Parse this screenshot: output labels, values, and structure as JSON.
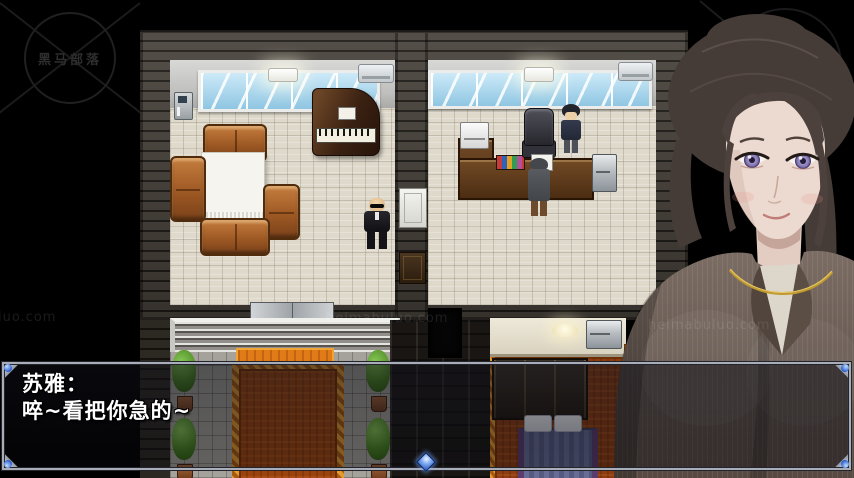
{
  "dialogue": {
    "speaker": "苏雅：",
    "text": "啐~看把你急的~"
  },
  "watermarks": {
    "logo_text": "黑马部落",
    "site_text": "heimabuluo.com"
  },
  "colors": {
    "background": "#000000",
    "dialog_border": "#a9adb8",
    "cursor_blue": "#3a6cd0",
    "carpet_orange": "#9c430d",
    "carpet_trim": "#c8791a",
    "window_glass": "#a8d8f0",
    "sofa_leather": "#a05a24",
    "eye_violet": "#8d7fb8",
    "portrait_jacket": "#6e6058"
  },
  "scene": {
    "rooms": [
      "living-room",
      "office",
      "bedroom",
      "entrance-walkway"
    ],
    "npcs": [
      "bald-man-black-suit",
      "black-haired-man",
      "gray-coat-person"
    ],
    "portrait": "young-woman-dark-hair-gray-blazer"
  }
}
